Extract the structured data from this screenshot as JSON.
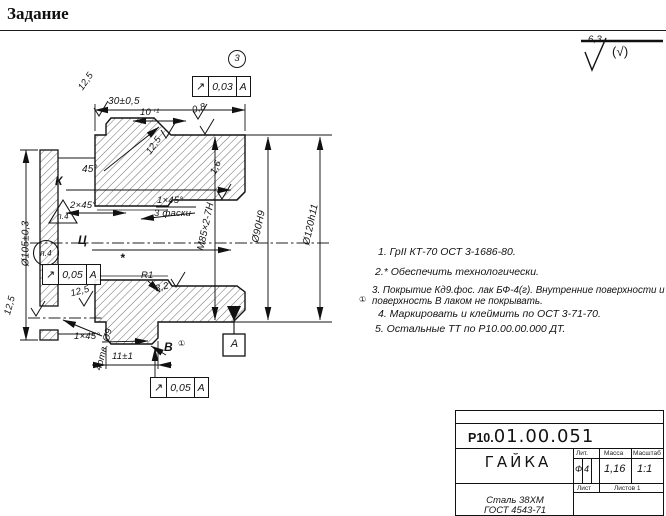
{
  "page": {
    "title": "Задание"
  },
  "labels": {
    "pos3": "3",
    "dim30": "30±0,5",
    "dim10": "10⁺¹",
    "deg45": "45°",
    "chamfer2x45": "2×45°",
    "k": "К",
    "flag_tri": "п.4",
    "c": "Ц",
    "flag_circ": "п.4",
    "dia105": "Ø105±0,3",
    "chamfer1x45_mid": "1×45°",
    "facets": "3 фаски",
    "thread": "М85×2-7Н",
    "dia90": "Ø90Н9",
    "dia120": "Ø120h11",
    "r1": "R1",
    "holes": "4отв. Ø9",
    "chamfer1x45_bot": "1×45°",
    "dim11": "11±1",
    "view_b": "В",
    "rev_mark": "①",
    "datum": "А",
    "asterisk": "*"
  },
  "roughness": {
    "general": "6,3",
    "general_alt": "(√)",
    "r08": "0,8",
    "r16": "1,6",
    "r32": "3,2",
    "r125_tl": "12,5",
    "r125_mid": "12,5",
    "r125_hole": "12,5",
    "r125_left": "12,5"
  },
  "tolerances": [
    {
      "symbol": "↗",
      "value": "0,03",
      "datum": "А"
    },
    {
      "symbol": "↗",
      "value": "0,05",
      "datum": "А"
    },
    {
      "symbol": "↗",
      "value": "0,05",
      "datum": "А"
    }
  ],
  "tech_requirements": [
    "1. ГрII КТ-70  ОСТ 3-1686-80.",
    "2.* Обеспечить технологически.",
    "3. Покрытие Кд9.фос. лак БФ-4(г). Внутренние поверхности и поверхность В лаком не покрывать.",
    "4. Маркировать и клеймить по ОСТ 3-71-70.",
    "5. Остальные ТТ по  Р10.00.00.000 ДТ."
  ],
  "title_block": {
    "doc_number_prefix": "Р10.",
    "doc_number": "01.00.051",
    "part_name": "ГАЙКА",
    "lit_label": "Лит.",
    "mass_label": "Масса",
    "scale_label": "Масштаб",
    "lit_value_1": "Ф",
    "lit_value_2": "4",
    "mass_value": "1,16",
    "scale_value": "1:1",
    "sheet_label": "Лист",
    "sheets_label": "Листов 1",
    "material_line1": "Сталь 38ХМ",
    "material_line2": "ГОСТ 4543-71"
  }
}
